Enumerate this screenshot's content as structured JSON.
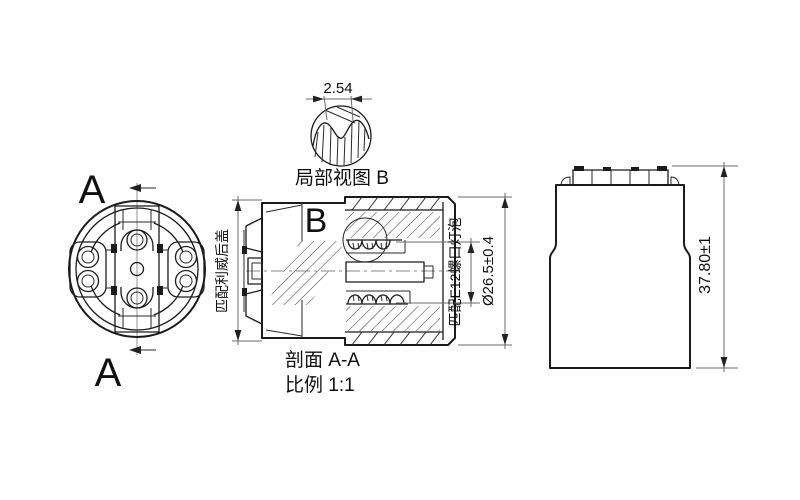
{
  "colors": {
    "background": "#ffffff",
    "line": "#1b1b1b",
    "dimension_line": "#6b6b6b"
  },
  "front_view": {
    "section_marker_top": "A",
    "section_marker_bottom": "A"
  },
  "detail_view": {
    "title": "局部视图 B",
    "pitch_dimension": "2.54"
  },
  "section_view": {
    "title": "剖面 A-A",
    "scale": "比例 1:1",
    "detail_marker": "B",
    "note_left": "匹配利威后盖",
    "note_right": "匹配E12螺口灯泡",
    "diameter_dimension": "Ø26.5±0.4"
  },
  "side_view": {
    "height_dimension": "37.80±1"
  }
}
